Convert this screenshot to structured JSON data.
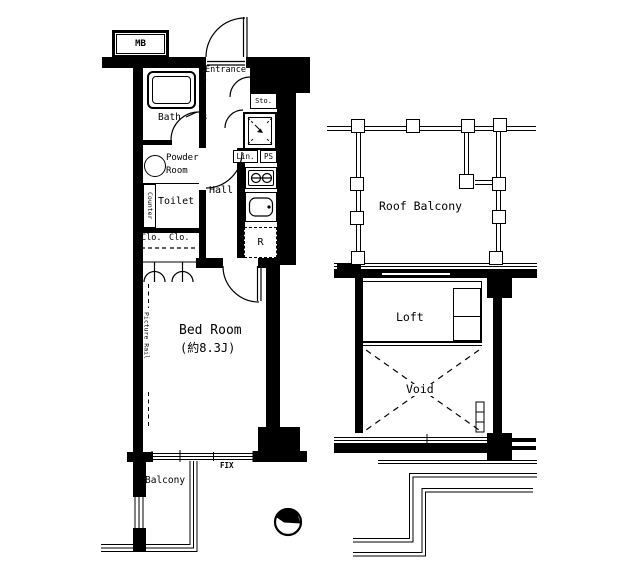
{
  "plan": {
    "colors": {
      "line": "#000000",
      "background": "#ffffff"
    },
    "left_unit": {
      "mb_label": "MB",
      "entrance_label": "Entrance",
      "entrance_picture_rail_label": "Picture Rail",
      "storage_label": "Sto.",
      "bath_label": "Bath",
      "powder_line1": "Powder",
      "powder_line2": "Room",
      "counter_label": "Counter",
      "toilet_label": "Toilet",
      "hall_label": "Hall",
      "linen_label": "Lin.",
      "pipe_space_label": "PS",
      "closet1_label": "Clo.",
      "closet2_label": "Clo.",
      "refrigerator_label": "R",
      "bedroom_label": "Bed Room",
      "bedroom_area_label": "(約8.3J)",
      "bedroom_picture_rail_label": "Picture Rail",
      "fix_label": "FIX",
      "balcony_label": "Balcony"
    },
    "right_section": {
      "roof_balcony_label": "Roof Balcony",
      "loft_label": "Loft",
      "void_label": "Void"
    }
  }
}
